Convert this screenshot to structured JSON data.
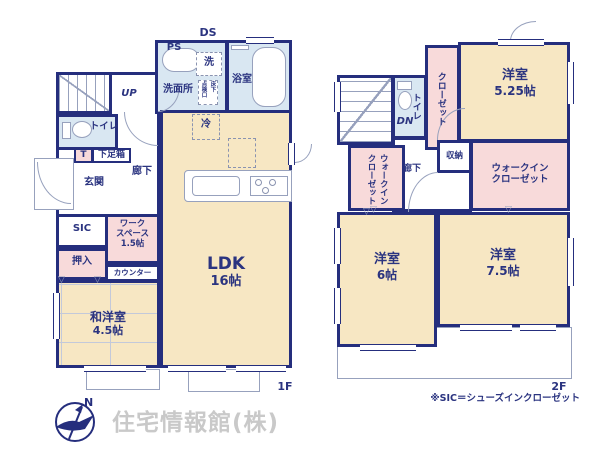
{
  "colors": {
    "wall": "#252e7d",
    "room_warm_beige": "#f7e7c3",
    "room_pink": "#f8dada",
    "room_blue": "#d9e7f2",
    "fixture_line": "#97a1bd",
    "label_text": "#2b3480",
    "company_gray": "#c9c9c9"
  },
  "floor1": {
    "floor_label": "1F",
    "ds": "DS",
    "ps": "PS",
    "laundry": "洗",
    "bathroom": "浴室",
    "washroom": "洗面所",
    "hatch_line1": "床下",
    "hatch_line2": "点検口",
    "up": "UP",
    "toilet": "トイレ",
    "tag_t": "T",
    "shoebox": "下足箱",
    "entrance": "玄関",
    "hallway": "廊下",
    "fridge": "冷",
    "ldk_name": "LDK",
    "ldk_size": "16帖",
    "sic": "SIC",
    "oshiire": "押入",
    "workspace_line1": "ワーク",
    "workspace_line2": "スペース",
    "workspace_size": "1.5帖",
    "counter": "カウンター",
    "tatami_room_name": "和洋室",
    "tatami_room_size": "4.5帖"
  },
  "floor2": {
    "floor_label": "2F",
    "closet": "クローゼット",
    "toilet": "トイレ",
    "dn": "DN",
    "room_a_name": "洋室",
    "room_a_size": "5.25帖",
    "wic_left_line1": "ウォークイン",
    "wic_left_line2": "クローゼット",
    "storage": "収納",
    "hallway": "廊下",
    "wic_right_line1": "ウォークイン",
    "wic_right_line2": "クローゼット",
    "room_b_name": "洋室",
    "room_b_size": "6帖",
    "room_c_name": "洋室",
    "room_c_size": "7.5帖"
  },
  "footer": {
    "note": "※SIC＝シューズインクローゼット",
    "company": "住宅情報館(株)",
    "compass_north": "N"
  }
}
